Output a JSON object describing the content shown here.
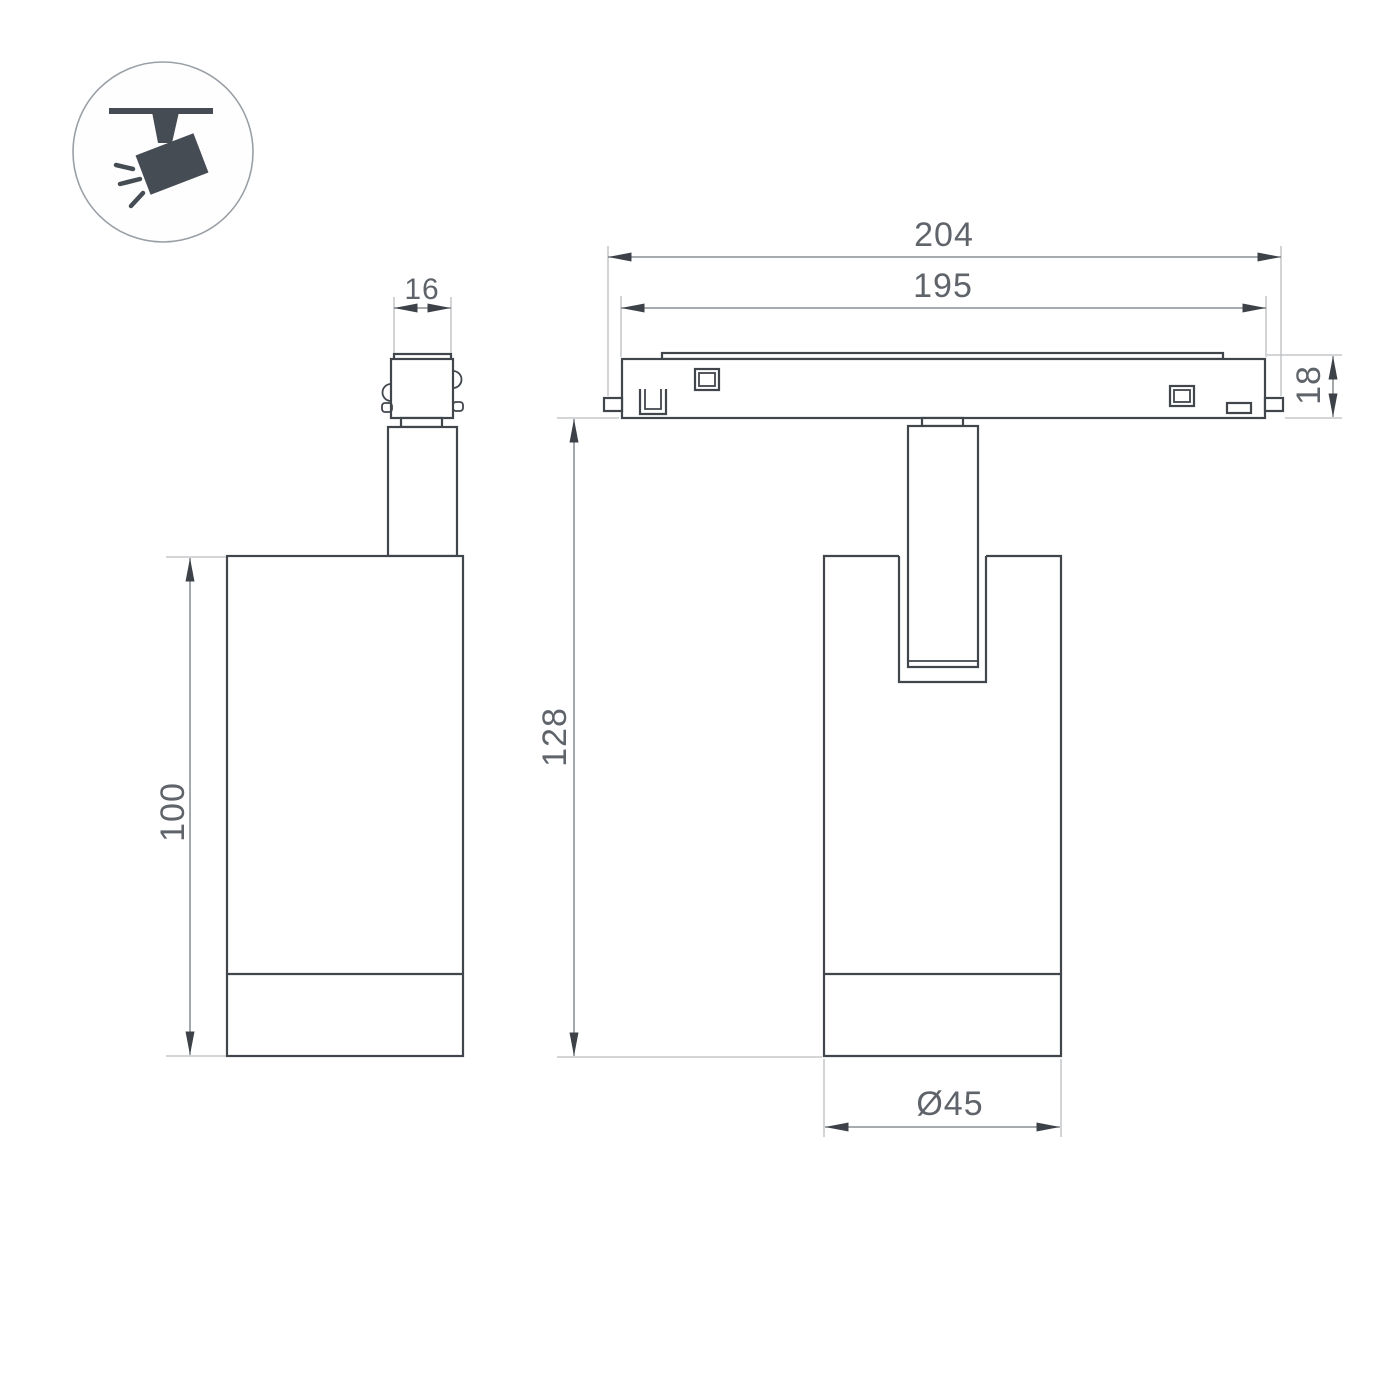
{
  "drawing": {
    "icon": {
      "name": "ceiling-spotlight-icon"
    },
    "side_view": {
      "connector_width": "16",
      "body_height": "100"
    },
    "front_view": {
      "track_overall_length": "204",
      "track_visible_length": "195",
      "track_height": "18",
      "fixture_height": "128",
      "body_diameter": "Ø45"
    },
    "colors": {
      "background": "#ffffff",
      "outline": "#41464d",
      "dimension_line": "#74797e",
      "extension_line": "#b9bcbf",
      "arrow": "#3d4248",
      "label_text": "#5f646a",
      "icon_fill": "#454c53",
      "icon_circle_stroke": "#9aa0a6"
    }
  }
}
